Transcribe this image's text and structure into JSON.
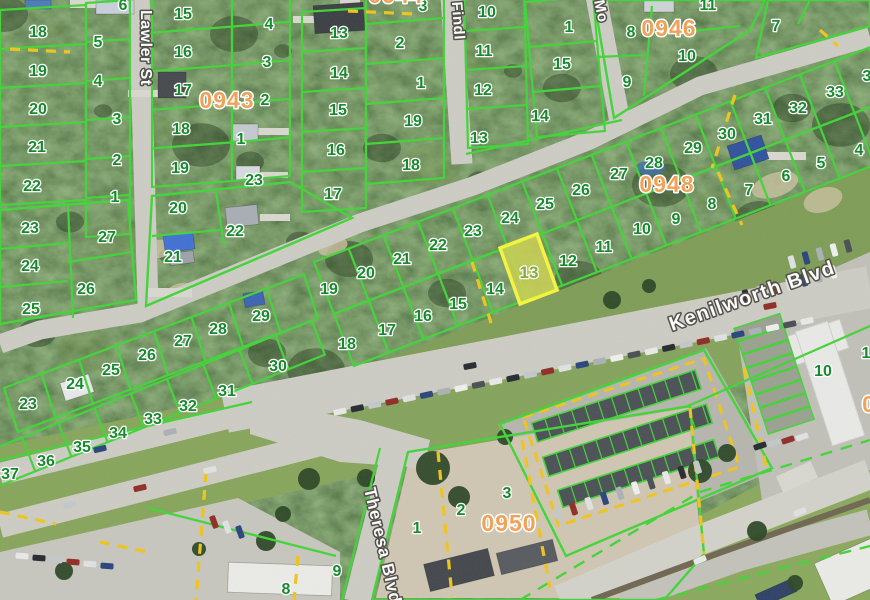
{
  "map_labels": {
    "streets": [
      {
        "name": "Lawler St",
        "x": 141,
        "y": 10,
        "rotation": 90
      },
      {
        "name": "Findl",
        "x": 452,
        "y": 2,
        "rotation": 86
      },
      {
        "name": "Mo",
        "x": 594,
        "y": 1,
        "rotation": 78
      },
      {
        "name": "Kenilworth Blvd",
        "x": 672,
        "y": 331,
        "rotation": -19.5
      },
      {
        "name": "Theresa Blvd",
        "x": 364,
        "y": 489,
        "rotation": 77
      }
    ],
    "blocks": [
      {
        "number": "0943",
        "x": 227,
        "y": 100
      },
      {
        "number": "0944",
        "x": 396,
        "y": -5,
        "partial": true
      },
      {
        "number": "0946",
        "x": 669,
        "y": 28
      },
      {
        "number": "0948",
        "x": 667,
        "y": 184
      },
      {
        "number": "0950",
        "x": 509,
        "y": 523
      },
      {
        "number": "0",
        "x": 869,
        "y": 404,
        "partial": true
      }
    ],
    "selected_lot": {
      "number": "13",
      "x": 529,
      "y": 272
    },
    "lots": [
      {
        "n": "6",
        "x": 123,
        "y": 4
      },
      {
        "n": "18",
        "x": 38,
        "y": 31
      },
      {
        "n": "5",
        "x": 98,
        "y": 41
      },
      {
        "n": "19",
        "x": 38,
        "y": 70
      },
      {
        "n": "4",
        "x": 98,
        "y": 80
      },
      {
        "n": "20",
        "x": 38,
        "y": 108
      },
      {
        "n": "3",
        "x": 117,
        "y": 118
      },
      {
        "n": "21",
        "x": 37,
        "y": 146
      },
      {
        "n": "2",
        "x": 117,
        "y": 159
      },
      {
        "n": "22",
        "x": 32,
        "y": 185
      },
      {
        "n": "1",
        "x": 115,
        "y": 196
      },
      {
        "n": "23",
        "x": 30,
        "y": 227
      },
      {
        "n": "27",
        "x": 107,
        "y": 236
      },
      {
        "n": "24",
        "x": 30,
        "y": 265
      },
      {
        "n": "26",
        "x": 86,
        "y": 288
      },
      {
        "n": "25",
        "x": 31,
        "y": 308
      },
      {
        "n": "15",
        "x": 183,
        "y": 13
      },
      {
        "n": "16",
        "x": 183,
        "y": 51
      },
      {
        "n": "17",
        "x": 183,
        "y": 89
      },
      {
        "n": "18",
        "x": 181,
        "y": 128
      },
      {
        "n": "19",
        "x": 180,
        "y": 167
      },
      {
        "n": "4",
        "x": 269,
        "y": 23
      },
      {
        "n": "3",
        "x": 267,
        "y": 61
      },
      {
        "n": "2",
        "x": 265,
        "y": 99
      },
      {
        "n": "1",
        "x": 241,
        "y": 138
      },
      {
        "n": "23",
        "x": 254,
        "y": 179
      },
      {
        "n": "20",
        "x": 178,
        "y": 207
      },
      {
        "n": "22",
        "x": 235,
        "y": 230
      },
      {
        "n": "21",
        "x": 173,
        "y": 256
      },
      {
        "n": "13",
        "x": 339,
        "y": 32
      },
      {
        "n": "3",
        "x": 423,
        "y": 5
      },
      {
        "n": "2",
        "x": 400,
        "y": 42
      },
      {
        "n": "14",
        "x": 339,
        "y": 72
      },
      {
        "n": "1",
        "x": 421,
        "y": 82
      },
      {
        "n": "15",
        "x": 338,
        "y": 109
      },
      {
        "n": "19",
        "x": 413,
        "y": 120
      },
      {
        "n": "16",
        "x": 336,
        "y": 149
      },
      {
        "n": "18",
        "x": 411,
        "y": 164
      },
      {
        "n": "17",
        "x": 333,
        "y": 193
      },
      {
        "n": "10",
        "x": 487,
        "y": 11
      },
      {
        "n": "11",
        "x": 484,
        "y": 50
      },
      {
        "n": "12",
        "x": 483,
        "y": 89
      },
      {
        "n": "13",
        "x": 479,
        "y": 137
      },
      {
        "n": "1",
        "x": 569,
        "y": 26
      },
      {
        "n": "15",
        "x": 562,
        "y": 63
      },
      {
        "n": "14",
        "x": 540,
        "y": 115
      },
      {
        "n": "11",
        "x": 708,
        "y": 4
      },
      {
        "n": "8",
        "x": 631,
        "y": 31
      },
      {
        "n": "10",
        "x": 687,
        "y": 55
      },
      {
        "n": "9",
        "x": 627,
        "y": 81
      },
      {
        "n": "7",
        "x": 776,
        "y": 25
      },
      {
        "n": "3",
        "x": 867,
        "y": 75,
        "partial": true
      },
      {
        "n": "19",
        "x": 329,
        "y": 288
      },
      {
        "n": "20",
        "x": 366,
        "y": 272
      },
      {
        "n": "21",
        "x": 402,
        "y": 258
      },
      {
        "n": "22",
        "x": 438,
        "y": 244
      },
      {
        "n": "23",
        "x": 473,
        "y": 230
      },
      {
        "n": "24",
        "x": 510,
        "y": 217
      },
      {
        "n": "25",
        "x": 545,
        "y": 203
      },
      {
        "n": "26",
        "x": 581,
        "y": 189
      },
      {
        "n": "27",
        "x": 619,
        "y": 173
      },
      {
        "n": "28",
        "x": 654,
        "y": 162
      },
      {
        "n": "29",
        "x": 693,
        "y": 147
      },
      {
        "n": "30",
        "x": 727,
        "y": 133
      },
      {
        "n": "31",
        "x": 763,
        "y": 118
      },
      {
        "n": "32",
        "x": 798,
        "y": 107
      },
      {
        "n": "33",
        "x": 835,
        "y": 91
      },
      {
        "n": "18",
        "x": 347,
        "y": 343
      },
      {
        "n": "17",
        "x": 387,
        "y": 329
      },
      {
        "n": "16",
        "x": 423,
        "y": 315
      },
      {
        "n": "15",
        "x": 458,
        "y": 303
      },
      {
        "n": "14",
        "x": 495,
        "y": 288
      },
      {
        "n": "12",
        "x": 568,
        "y": 260
      },
      {
        "n": "11",
        "x": 604,
        "y": 246
      },
      {
        "n": "10",
        "x": 642,
        "y": 228
      },
      {
        "n": "9",
        "x": 676,
        "y": 218
      },
      {
        "n": "8",
        "x": 712,
        "y": 203
      },
      {
        "n": "7",
        "x": 749,
        "y": 189
      },
      {
        "n": "6",
        "x": 786,
        "y": 175
      },
      {
        "n": "5",
        "x": 821,
        "y": 162
      },
      {
        "n": "4",
        "x": 859,
        "y": 149
      },
      {
        "n": "23",
        "x": 28,
        "y": 403
      },
      {
        "n": "24",
        "x": 75,
        "y": 383
      },
      {
        "n": "25",
        "x": 111,
        "y": 369
      },
      {
        "n": "26",
        "x": 147,
        "y": 354
      },
      {
        "n": "27",
        "x": 183,
        "y": 340
      },
      {
        "n": "28",
        "x": 218,
        "y": 328
      },
      {
        "n": "29",
        "x": 261,
        "y": 315
      },
      {
        "n": "37",
        "x": 10,
        "y": 473
      },
      {
        "n": "36",
        "x": 46,
        "y": 460
      },
      {
        "n": "35",
        "x": 82,
        "y": 446
      },
      {
        "n": "34",
        "x": 118,
        "y": 432
      },
      {
        "n": "33",
        "x": 153,
        "y": 418
      },
      {
        "n": "32",
        "x": 188,
        "y": 405
      },
      {
        "n": "31",
        "x": 227,
        "y": 390
      },
      {
        "n": "30",
        "x": 278,
        "y": 365
      },
      {
        "n": "10",
        "x": 823,
        "y": 370
      },
      {
        "n": "1",
        "x": 866,
        "y": 352,
        "partial": true
      },
      {
        "n": "8",
        "x": 286,
        "y": 588
      },
      {
        "n": "9",
        "x": 337,
        "y": 570
      },
      {
        "n": "1",
        "x": 417,
        "y": 527
      },
      {
        "n": "2",
        "x": 461,
        "y": 509
      },
      {
        "n": "3",
        "x": 507,
        "y": 492
      }
    ]
  },
  "colors": {
    "parcel_line": "#3fd435",
    "highlight_border": "#f6f63b",
    "highlight_fill": "#cdd24f",
    "lot_text": "#178a2e",
    "block_text": "#f0a259",
    "street_text": "#fbfbf9",
    "dash_yellow": "#f0c419"
  }
}
